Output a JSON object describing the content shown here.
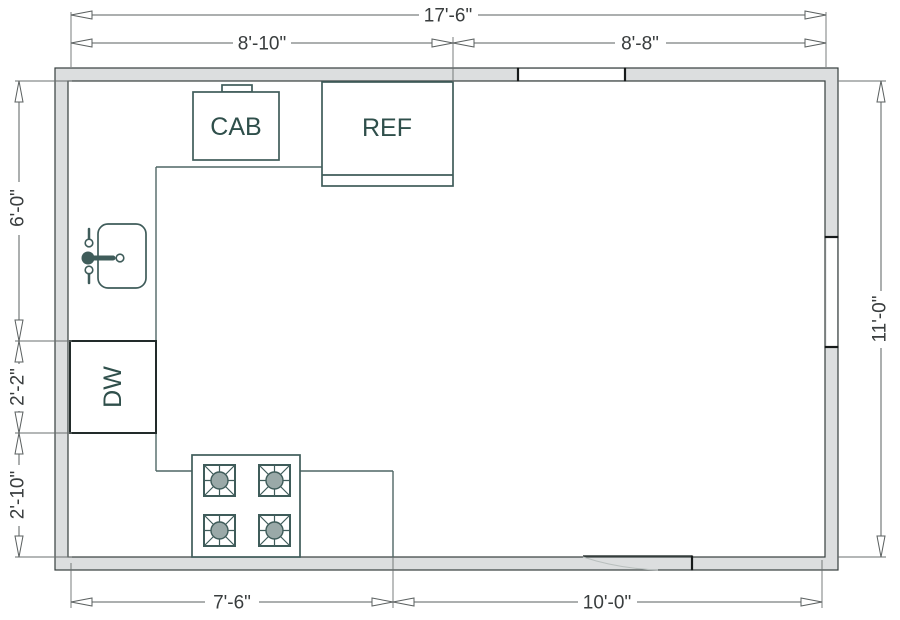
{
  "title": "Kitchen floor plan",
  "dimensions": {
    "top_total": "17'-6\"",
    "top_left": "8'-10\"",
    "top_right": "8'-8\"",
    "left_upper": "6'-0\"",
    "left_middle": "2'-2\"",
    "left_lower": "2'-10\"",
    "right_full": "11'-0\"",
    "bottom_left": "7'-6\"",
    "bottom_right": "10'-0\""
  },
  "labels": {
    "cabinet": "CAB",
    "refrigerator": "REF",
    "dishwasher": "DW"
  },
  "fixtures": {
    "sink_icon": "sink-with-faucet",
    "stove_icon": "four-burner-cooktop",
    "door_icon": "door-opening-swing",
    "window_icons": [
      "top-wall-window",
      "right-wall-window"
    ]
  },
  "colors": {
    "wall_fill": "#dcdedf",
    "wall_stroke": "#353e3d",
    "fixture_stroke": "#3f5c5a",
    "counter_stroke": "#4f6765",
    "dishwasher_stroke": "#222b2a",
    "label_text": "#2f4f4b",
    "dimension_line": "#5a5f5f",
    "dimension_text": "#393d3e",
    "burner_fill": "#9aa9a8",
    "window_cap": "#161a1a",
    "background": "#ffffff"
  }
}
